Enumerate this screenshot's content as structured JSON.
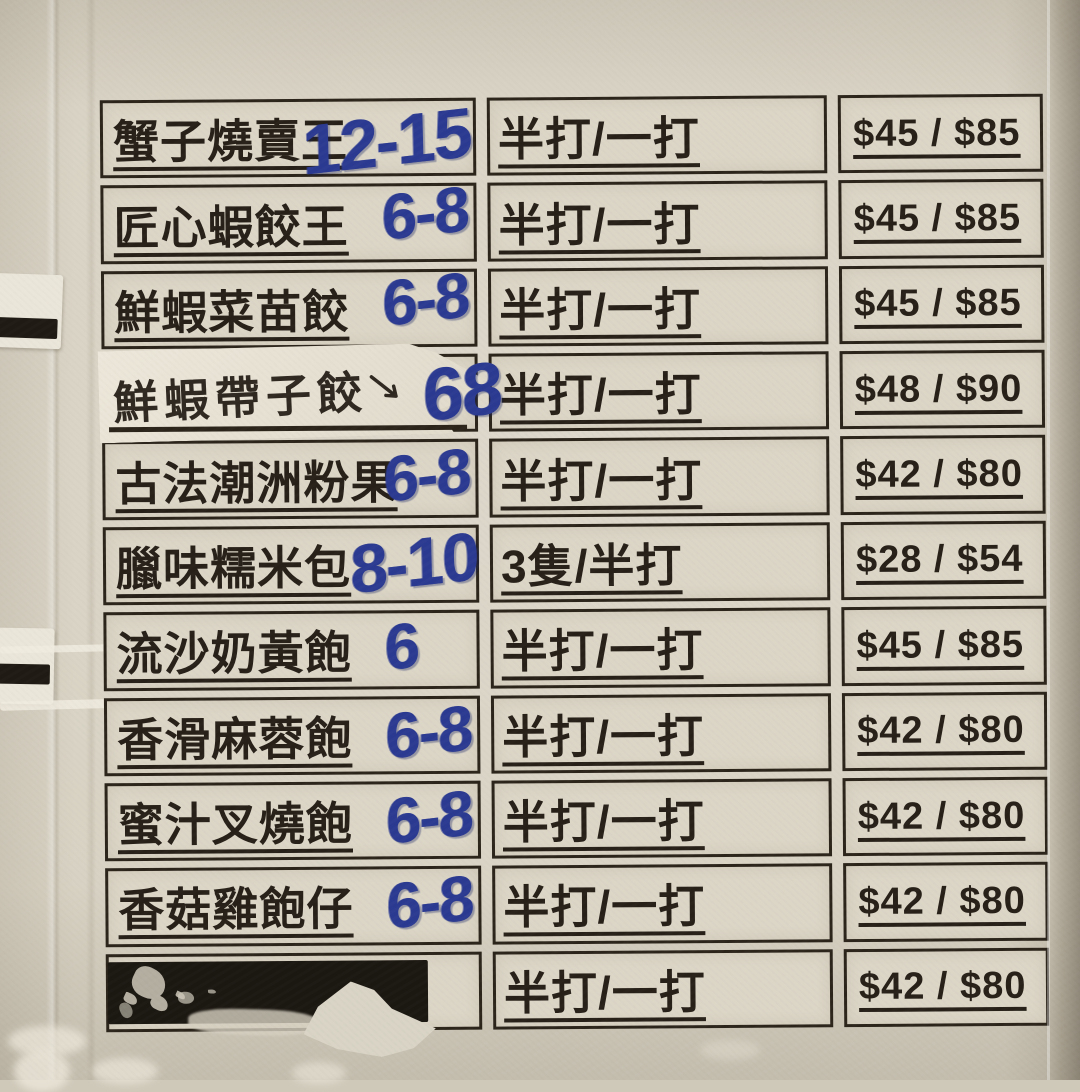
{
  "table": {
    "columns": [
      "item",
      "portion",
      "price"
    ],
    "rows": [
      {
        "type": "normal",
        "item": "蟹子燒賣王",
        "handwritten": "12-15",
        "portion": "半打/一打",
        "price": "$45 / $85"
      },
      {
        "type": "normal",
        "item": "匠心蝦餃王",
        "handwritten": "6-8",
        "portion": "半打/一打",
        "price": "$45 / $85"
      },
      {
        "type": "normal",
        "item": "鮮蝦菜苗餃",
        "handwritten": "6-8",
        "portion": "半打/一打",
        "price": "$45 / $85"
      },
      {
        "type": "sticker",
        "item": "鮮蝦帶子餃",
        "handwritten": "68",
        "portion": "半打/一打",
        "price": "$48 / $90"
      },
      {
        "type": "normal",
        "item": "古法潮洲粉果",
        "handwritten": "6-8",
        "portion": "半打/一打",
        "price": "$42 / $80"
      },
      {
        "type": "normal",
        "item": "臘味糯米包",
        "handwritten": "8-10",
        "portion": "3隻/半打",
        "price": "$28 / $54"
      },
      {
        "type": "normal",
        "item": "流沙奶黃飽",
        "handwritten": "6",
        "portion": "半打/一打",
        "price": "$45 / $85"
      },
      {
        "type": "normal",
        "item": "香滑麻蓉飽",
        "handwritten": "6-8",
        "portion": "半打/一打",
        "price": "$42 / $80"
      },
      {
        "type": "normal",
        "item": "蜜汁叉燒飽",
        "handwritten": "6-8",
        "portion": "半打/一打",
        "price": "$42 / $80"
      },
      {
        "type": "normal",
        "item": "香菇雞飽仔",
        "handwritten": "6-8",
        "portion": "半打/一打",
        "price": "$42 / $80"
      },
      {
        "type": "redacted",
        "item": "",
        "handwritten": "",
        "portion": "半打/一打",
        "price": "$42 / $80"
      }
    ],
    "colors": {
      "paper": "#d8d2c3",
      "cell": "#dcd6c7",
      "printed_ink": "#262019",
      "marker_blue": "#2b3a91",
      "redaction_black": "#1b1711",
      "sticker_white": "#ece7da"
    }
  }
}
